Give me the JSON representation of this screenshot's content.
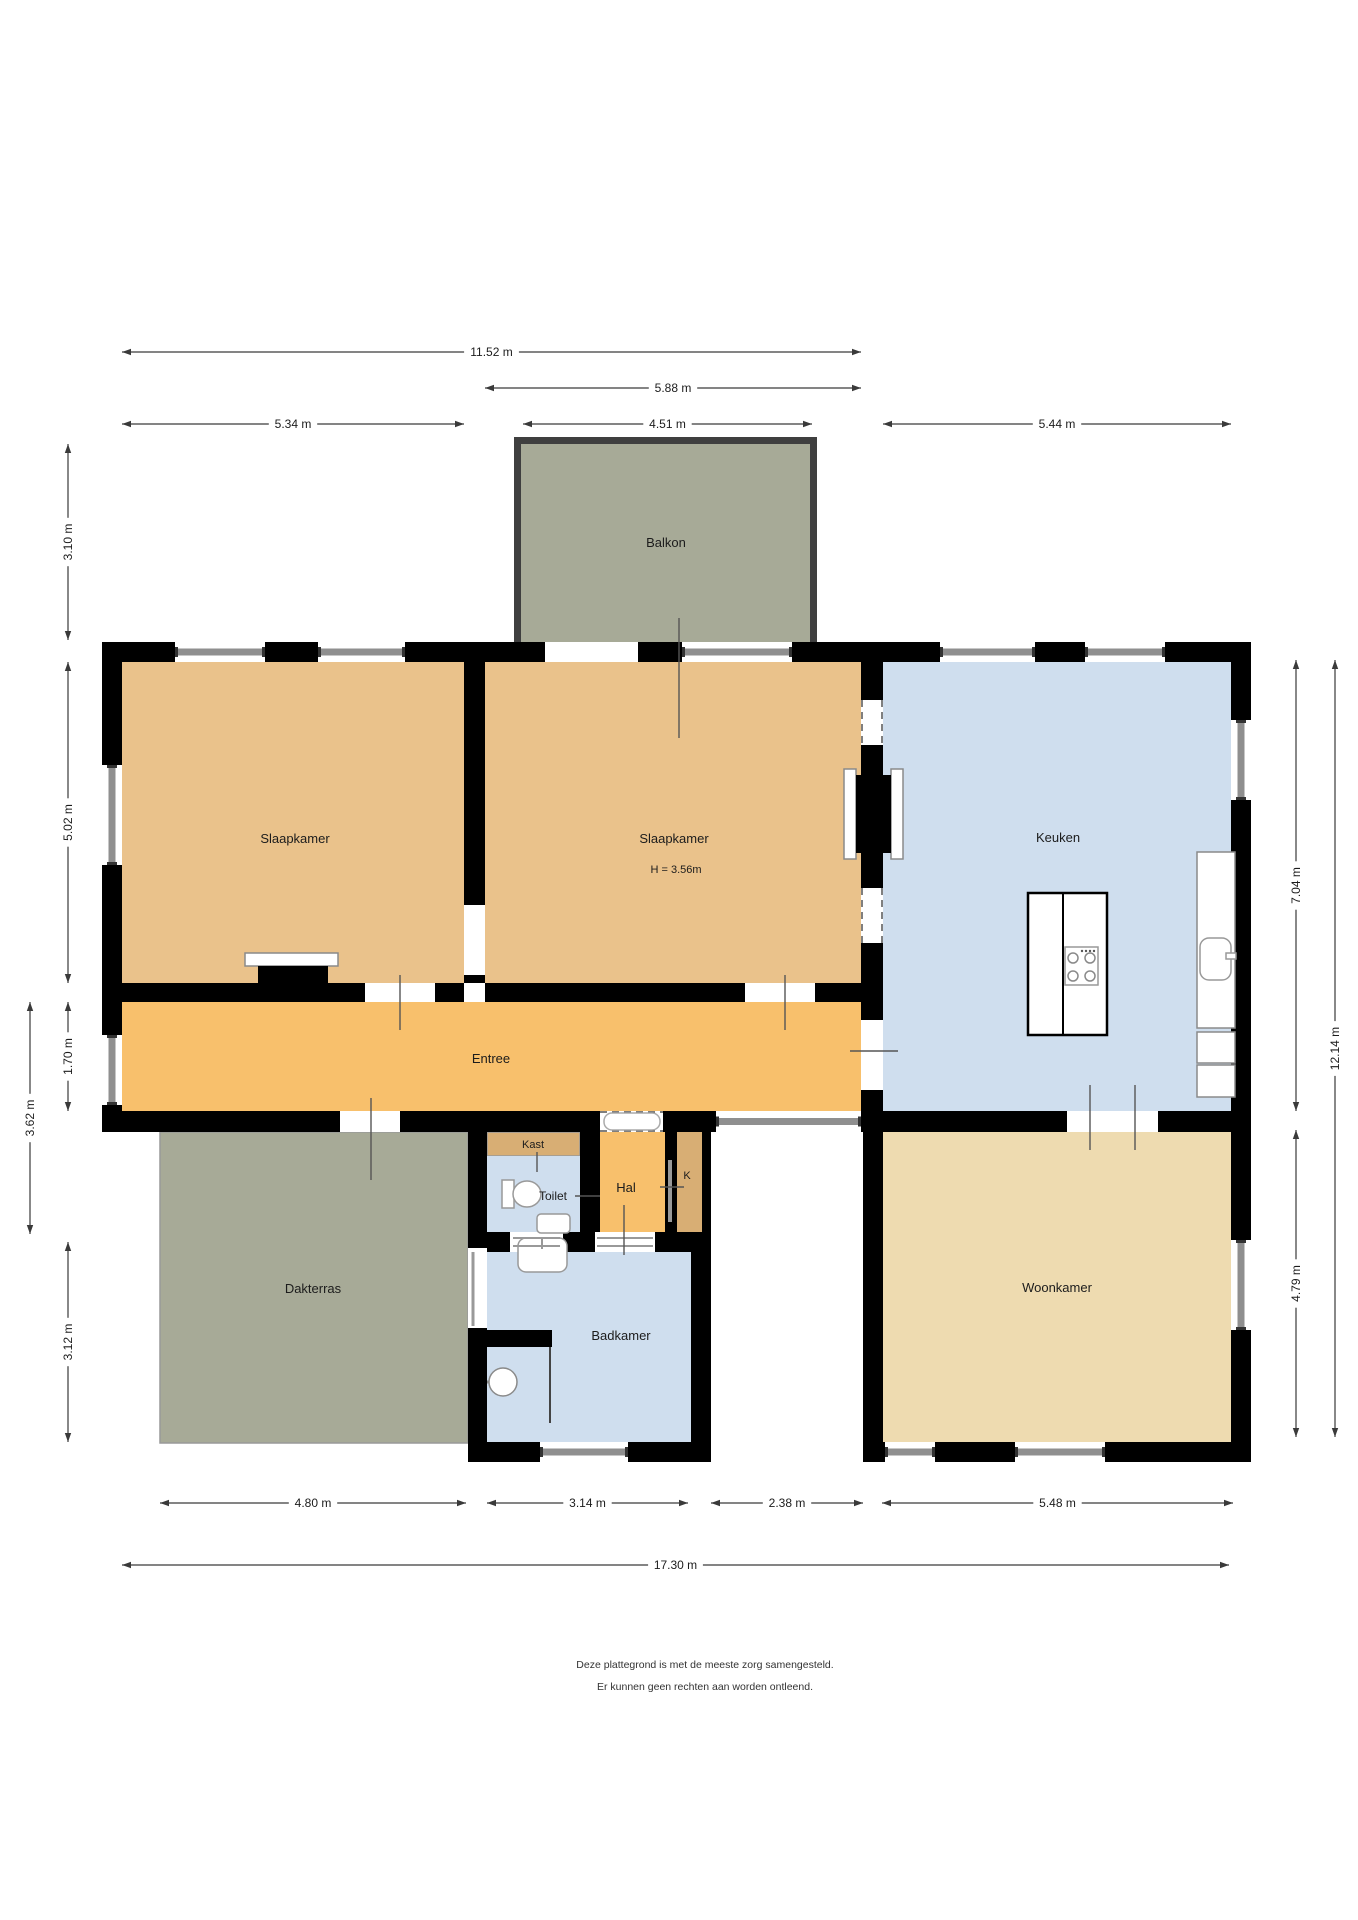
{
  "title": "Plattegrond",
  "colors": {
    "wall": "#000000",
    "bedroom": "#eac28b",
    "hallway": "#f8c06c",
    "closet": "#d8ae74",
    "wet": "#cfdeee",
    "living": "#eedbb0",
    "outdoor": "#a7aa97",
    "window_grey": "#8f8f8f",
    "dim_line": "#3a3a3a",
    "label": "#1c1c1c",
    "fixture_stroke": "#8a8a8a",
    "balcony_edge": "#3f3f3f"
  },
  "rooms": [
    {
      "name": "balkon",
      "label": "Balkon",
      "x": 521,
      "y": 444,
      "w": 289,
      "h": 198,
      "fill": "outdoor",
      "lx": 666,
      "ly": 547,
      "fs": 13
    },
    {
      "name": "slaapkamer-links",
      "label": "Slaapkamer",
      "x": 122,
      "y": 662,
      "w": 342,
      "h": 321,
      "fill": "bedroom",
      "lx": 295,
      "ly": 843,
      "fs": 13
    },
    {
      "name": "slaapkamer-midden",
      "label": "Slaapkamer",
      "sublabel": "H = 3.56m",
      "x": 485,
      "y": 662,
      "w": 376,
      "h": 321,
      "fill": "bedroom",
      "lx": 674,
      "ly": 843,
      "slx": 676,
      "sly": 873,
      "fs": 13
    },
    {
      "name": "keuken",
      "label": "Keuken",
      "x": 883,
      "y": 662,
      "w": 348,
      "h": 449,
      "fill": "wet",
      "lx": 1058,
      "ly": 842,
      "fs": 13
    },
    {
      "name": "entree",
      "label": "Entree",
      "x": 122,
      "y": 1002,
      "w": 739,
      "h": 109,
      "fill": "hallway",
      "lx": 491,
      "ly": 1063,
      "fs": 13
    },
    {
      "name": "kast",
      "label": "Kast",
      "x": 487,
      "y": 1132,
      "w": 93,
      "h": 24,
      "fill": "closet",
      "stroke": "#999999",
      "lx": 533,
      "ly": 1148,
      "fs": 11
    },
    {
      "name": "toilet",
      "label": "Toilet",
      "x": 487,
      "y": 1156,
      "w": 93,
      "h": 76,
      "fill": "wet",
      "lx": 553,
      "ly": 1200,
      "fs": 12
    },
    {
      "name": "hal",
      "label": "Hal",
      "x": 600,
      "y": 1132,
      "w": 65,
      "h": 100,
      "fill": "hallway",
      "lx": 626,
      "ly": 1192,
      "fs": 13
    },
    {
      "name": "kast-k",
      "label": "K",
      "x": 677,
      "y": 1132,
      "w": 25,
      "h": 100,
      "fill": "closet",
      "lx": 687,
      "ly": 1179,
      "fs": 11
    },
    {
      "name": "badkamer",
      "label": "Badkamer",
      "x": 487,
      "y": 1252,
      "w": 204,
      "h": 190,
      "fill": "wet",
      "lx": 621,
      "ly": 1340,
      "fs": 13
    },
    {
      "name": "dakterras",
      "label": "Dakterras",
      "x": 160,
      "y": 1132,
      "w": 308,
      "h": 311,
      "fill": "outdoor",
      "stroke": "#999999",
      "lx": 313,
      "ly": 1293,
      "fs": 13
    },
    {
      "name": "woonkamer",
      "label": "Woonkamer",
      "x": 883,
      "y": 1132,
      "w": 348,
      "h": 310,
      "fill": "living",
      "lx": 1057,
      "ly": 1292,
      "fs": 13
    }
  ],
  "walls": [
    [
      102,
      642,
      1149,
      20
    ],
    [
      102,
      642,
      20,
      490
    ],
    [
      102,
      1111,
      1149,
      21
    ],
    [
      1231,
      642,
      20,
      820
    ],
    [
      464,
      662,
      21,
      321
    ],
    [
      122,
      983,
      342,
      19
    ],
    [
      485,
      983,
      398,
      19
    ],
    [
      861,
      662,
      22,
      449
    ],
    [
      468,
      1132,
      19,
      310
    ],
    [
      702,
      1132,
      9,
      100
    ],
    [
      691,
      1232,
      20,
      210
    ],
    [
      863,
      1132,
      20,
      310
    ],
    [
      580,
      1132,
      20,
      100
    ],
    [
      665,
      1132,
      12,
      100
    ],
    [
      468,
      1232,
      223,
      20
    ],
    [
      468,
      1442,
      243,
      20
    ],
    [
      863,
      1442,
      388,
      20
    ]
  ],
  "door_gaps": [
    {
      "name": "door-balkon",
      "x": 545,
      "y": 642,
      "w": 93,
      "h": 20
    },
    {
      "name": "door-slaapkamer-links",
      "x": 365,
      "y": 983,
      "w": 70,
      "h": 19
    },
    {
      "name": "door-slaapkamer-midden",
      "x": 745,
      "y": 983,
      "w": 70,
      "h": 19
    },
    {
      "name": "door-tussen-slaapkamers",
      "x": 464,
      "y": 905,
      "w": 21,
      "h": 70
    },
    {
      "name": "door-entree-keuken",
      "x": 861,
      "y": 1020,
      "w": 22,
      "h": 70
    },
    {
      "name": "door-dakterras",
      "x": 340,
      "y": 1111,
      "w": 60,
      "h": 21
    },
    {
      "name": "door-keuken-woonkamer",
      "x": 1067,
      "y": 1111,
      "w": 91,
      "h": 21
    },
    {
      "name": "door-toilet",
      "x": 510,
      "y": 1232,
      "w": 53,
      "h": 20
    },
    {
      "name": "door-voordeur",
      "x": 595,
      "y": 1232,
      "w": 60,
      "h": 20
    }
  ],
  "dashed_openings": [
    {
      "name": "opening-wand-boven",
      "x": 861,
      "y": 700,
      "w": 22,
      "h": 45
    },
    {
      "name": "opening-wand-onder",
      "x": 861,
      "y": 888,
      "w": 22,
      "h": 55
    },
    {
      "name": "opening-entree-hal",
      "x": 600,
      "y": 1111,
      "w": 63,
      "h": 21
    }
  ],
  "windows_h": [
    [
      175,
      642,
      90,
      20
    ],
    [
      318,
      642,
      87,
      20
    ],
    [
      682,
      642,
      110,
      20
    ],
    [
      940,
      642,
      95,
      20
    ],
    [
      1085,
      642,
      80,
      20
    ],
    [
      716,
      1111,
      145,
      21
    ],
    [
      540,
      1442,
      88,
      20
    ],
    [
      885,
      1442,
      50,
      20
    ],
    [
      1015,
      1442,
      90,
      20
    ]
  ],
  "windows_v": [
    [
      102,
      765,
      20,
      100
    ],
    [
      102,
      1035,
      20,
      70
    ],
    [
      1231,
      720,
      20,
      80
    ],
    [
      1231,
      1240,
      20,
      90
    ]
  ],
  "balcony_edges": [
    [
      514,
      437,
      7,
      205
    ],
    [
      810,
      437,
      7,
      205
    ],
    [
      514,
      437,
      303,
      7
    ]
  ],
  "fixtures": [
    {
      "name": "wardrobe-top",
      "t": "rect",
      "x": 245,
      "y": 953,
      "w": 93,
      "h": 13,
      "f": "#ffffff",
      "s": "#8a8a8a"
    },
    {
      "name": "wardrobe-base",
      "t": "rect",
      "x": 258,
      "y": 966,
      "w": 70,
      "h": 36,
      "f": "#000000"
    },
    {
      "name": "kitchen-island",
      "t": "rect",
      "x": 1028,
      "y": 893,
      "w": 79,
      "h": 142,
      "f": "#ffffff",
      "s": "#000000",
      "sw": 2.5
    },
    {
      "name": "kitchen-island-divider",
      "t": "line",
      "x1": 1063,
      "y1": 893,
      "x2": 1063,
      "y2": 1035,
      "s": "#000000",
      "sw": 2
    },
    {
      "name": "stove",
      "t": "rect",
      "x": 1065,
      "y": 947,
      "w": 33,
      "h": 38,
      "f": "#ffffff",
      "s": "#999999"
    },
    {
      "name": "burner",
      "t": "circle",
      "cx": 1073,
      "cy": 958,
      "r": 5,
      "f": "none",
      "s": "#8a8a8a"
    },
    {
      "name": "burner",
      "t": "circle",
      "cx": 1090,
      "cy": 958,
      "r": 5,
      "f": "none",
      "s": "#8a8a8a"
    },
    {
      "name": "burner",
      "t": "circle",
      "cx": 1073,
      "cy": 976,
      "r": 5,
      "f": "none",
      "s": "#8a8a8a"
    },
    {
      "name": "burner",
      "t": "circle",
      "cx": 1090,
      "cy": 976,
      "r": 5,
      "f": "none",
      "s": "#8a8a8a"
    },
    {
      "name": "stove-knob",
      "t": "circle",
      "cx": 1082,
      "cy": 951,
      "r": 1.2,
      "f": "#555555"
    },
    {
      "name": "stove-knob",
      "t": "circle",
      "cx": 1086,
      "cy": 951,
      "r": 1.2,
      "f": "#555555"
    },
    {
      "name": "stove-knob",
      "t": "circle",
      "cx": 1090,
      "cy": 951,
      "r": 1.2,
      "f": "#555555"
    },
    {
      "name": "stove-knob",
      "t": "circle",
      "cx": 1094,
      "cy": 951,
      "r": 1.2,
      "f": "#555555"
    },
    {
      "name": "counter",
      "t": "rect",
      "x": 1197,
      "y": 852,
      "w": 38,
      "h": 176,
      "f": "#ffffff",
      "s": "#8a8a8a"
    },
    {
      "name": "kitchen-sink",
      "t": "rect",
      "x": 1200,
      "y": 938,
      "w": 31,
      "h": 42,
      "rx": 9,
      "f": "#ffffff",
      "s": "#999999"
    },
    {
      "name": "kitchen-tap",
      "t": "rect",
      "x": 1226,
      "y": 953,
      "w": 10,
      "h": 6,
      "f": "#ffffff",
      "s": "#999999"
    },
    {
      "name": "counter-box",
      "t": "rect",
      "x": 1197,
      "y": 1032,
      "w": 38,
      "h": 31,
      "f": "#ffffff",
      "s": "#8a8a8a"
    },
    {
      "name": "counter-box",
      "t": "rect",
      "x": 1197,
      "y": 1065,
      "w": 38,
      "h": 32,
      "f": "#ffffff",
      "s": "#8a8a8a"
    },
    {
      "name": "toilet-tank",
      "t": "rect",
      "x": 502,
      "y": 1180,
      "w": 12,
      "h": 28,
      "f": "#ffffff",
      "s": "#999999"
    },
    {
      "name": "toilet-bowl",
      "t": "ellipse",
      "cx": 527,
      "cy": 1194,
      "rx": 14,
      "ry": 13,
      "f": "#ffffff",
      "s": "#999999"
    },
    {
      "name": "toilet-sink",
      "t": "rect",
      "x": 537,
      "y": 1214,
      "w": 33,
      "h": 19,
      "rx": 4,
      "f": "#ffffff",
      "s": "#999999"
    },
    {
      "name": "bathroom-sink",
      "t": "rect",
      "x": 518,
      "y": 1238,
      "w": 49,
      "h": 34,
      "rx": 8,
      "f": "#ffffff",
      "s": "#999999"
    },
    {
      "name": "bathroom-tap",
      "t": "line",
      "x1": 542,
      "y1": 1238,
      "x2": 542,
      "y2": 1249,
      "s": "#999999",
      "sw": 2
    },
    {
      "name": "shower-wall",
      "t": "rect",
      "x": 487,
      "y": 1330,
      "w": 65,
      "h": 17,
      "f": "#000000"
    },
    {
      "name": "shower-screen",
      "t": "line",
      "x1": 550,
      "y1": 1347,
      "x2": 550,
      "y2": 1423,
      "s": "#444444",
      "sw": 2
    },
    {
      "name": "shower-arm",
      "t": "line",
      "x1": 487,
      "y1": 1382,
      "x2": 502,
      "y2": 1382,
      "s": "#8a8a8a",
      "sw": 3
    },
    {
      "name": "shower-head",
      "t": "circle",
      "cx": 503,
      "cy": 1382,
      "r": 14,
      "f": "#ffffff",
      "s": "#8a8a8a"
    },
    {
      "name": "terrace-door-opening",
      "t": "rect",
      "x": 468,
      "y": 1248,
      "w": 19,
      "h": 80,
      "f": "#ffffff"
    },
    {
      "name": "terrace-door-panel",
      "t": "line",
      "x1": 473,
      "y1": 1252,
      "x2": 473,
      "y2": 1326,
      "s": "#999999",
      "sw": 3
    },
    {
      "name": "threshold-pill",
      "t": "rect",
      "x": 604,
      "y": 1113,
      "w": 56,
      "h": 17,
      "rx": 8,
      "f": "#ffffff",
      "s": "#aaaaaa"
    },
    {
      "name": "shaft-liner",
      "t": "rect",
      "x": 844,
      "y": 769,
      "w": 12,
      "h": 90,
      "f": "#ffffff",
      "s": "#8a8a8a"
    },
    {
      "name": "shaft-liner",
      "t": "rect",
      "x": 891,
      "y": 769,
      "w": 12,
      "h": 90,
      "f": "#ffffff",
      "s": "#8a8a8a"
    },
    {
      "name": "shaft",
      "t": "rect",
      "x": 856,
      "y": 775,
      "w": 35,
      "h": 78,
      "f": "#000000"
    },
    {
      "name": "door-toilet-lines",
      "t": "line",
      "x1": 513,
      "y1": 1238,
      "x2": 560,
      "y2": 1238,
      "s": "#999999",
      "sw": 2
    },
    {
      "name": "door-toilet-lines",
      "t": "line",
      "x1": 513,
      "y1": 1246,
      "x2": 560,
      "y2": 1246,
      "s": "#999999",
      "sw": 2
    },
    {
      "name": "front-door-lines",
      "t": "line",
      "x1": 597,
      "y1": 1238,
      "x2": 653,
      "y2": 1238,
      "s": "#999999",
      "sw": 2
    },
    {
      "name": "front-door-lines",
      "t": "line",
      "x1": 597,
      "y1": 1246,
      "x2": 653,
      "y2": 1246,
      "s": "#999999",
      "sw": 2
    },
    {
      "name": "k-door",
      "t": "line",
      "x1": 670,
      "y1": 1160,
      "x2": 670,
      "y2": 1222,
      "s": "#999999",
      "sw": 4
    }
  ],
  "ticks": [
    [
      400,
      975,
      400,
      1030
    ],
    [
      785,
      975,
      785,
      1030
    ],
    [
      679,
      618,
      679,
      738
    ],
    [
      371,
      1098,
      371,
      1180
    ],
    [
      850,
      1051,
      898,
      1051
    ],
    [
      1090,
      1085,
      1090,
      1150
    ],
    [
      1135,
      1085,
      1135,
      1150
    ],
    [
      624,
      1205,
      624,
      1255
    ],
    [
      660,
      1187,
      684,
      1187
    ],
    [
      575,
      1196,
      600,
      1196
    ],
    [
      537,
      1152,
      537,
      1172
    ]
  ],
  "dimensions_h": [
    {
      "label": "11.52 m",
      "x1": 122,
      "x2": 861,
      "y": 352
    },
    {
      "label": "5.88 m",
      "x1": 485,
      "x2": 861,
      "y": 388
    },
    {
      "label": "5.34 m",
      "x1": 122,
      "x2": 464,
      "y": 424
    },
    {
      "label": "4.51 m",
      "x1": 523,
      "x2": 812,
      "y": 424
    },
    {
      "label": "5.44 m",
      "x1": 883,
      "x2": 1231,
      "y": 424
    },
    {
      "label": "4.80 m",
      "x1": 160,
      "x2": 466,
      "y": 1503
    },
    {
      "label": "3.14 m",
      "x1": 487,
      "x2": 688,
      "y": 1503
    },
    {
      "label": "2.38 m",
      "x1": 711,
      "x2": 863,
      "y": 1503
    },
    {
      "label": "5.48 m",
      "x1": 882,
      "x2": 1233,
      "y": 1503
    },
    {
      "label": "17.30 m",
      "x1": 122,
      "x2": 1229,
      "y": 1565
    }
  ],
  "dimensions_v": [
    {
      "label": "3.10 m",
      "y1": 444,
      "y2": 640,
      "x": 68
    },
    {
      "label": "5.02 m",
      "y1": 662,
      "y2": 983,
      "x": 68
    },
    {
      "label": "1.70 m",
      "y1": 1002,
      "y2": 1111,
      "x": 68
    },
    {
      "label": "3.62 m",
      "y1": 1002,
      "y2": 1234,
      "x": 30
    },
    {
      "label": "3.12 m",
      "y1": 1242,
      "y2": 1442,
      "x": 68
    },
    {
      "label": "7.04 m",
      "y1": 660,
      "y2": 1111,
      "x": 1296
    },
    {
      "label": "4.79 m",
      "y1": 1130,
      "y2": 1437,
      "x": 1296
    },
    {
      "label": "12.14 m",
      "y1": 660,
      "y2": 1437,
      "x": 1335
    }
  ],
  "footer": {
    "line1": "Deze plattegrond is met de meeste zorg samengesteld.",
    "line2": "Er kunnen geen rechten aan worden ontleend."
  }
}
